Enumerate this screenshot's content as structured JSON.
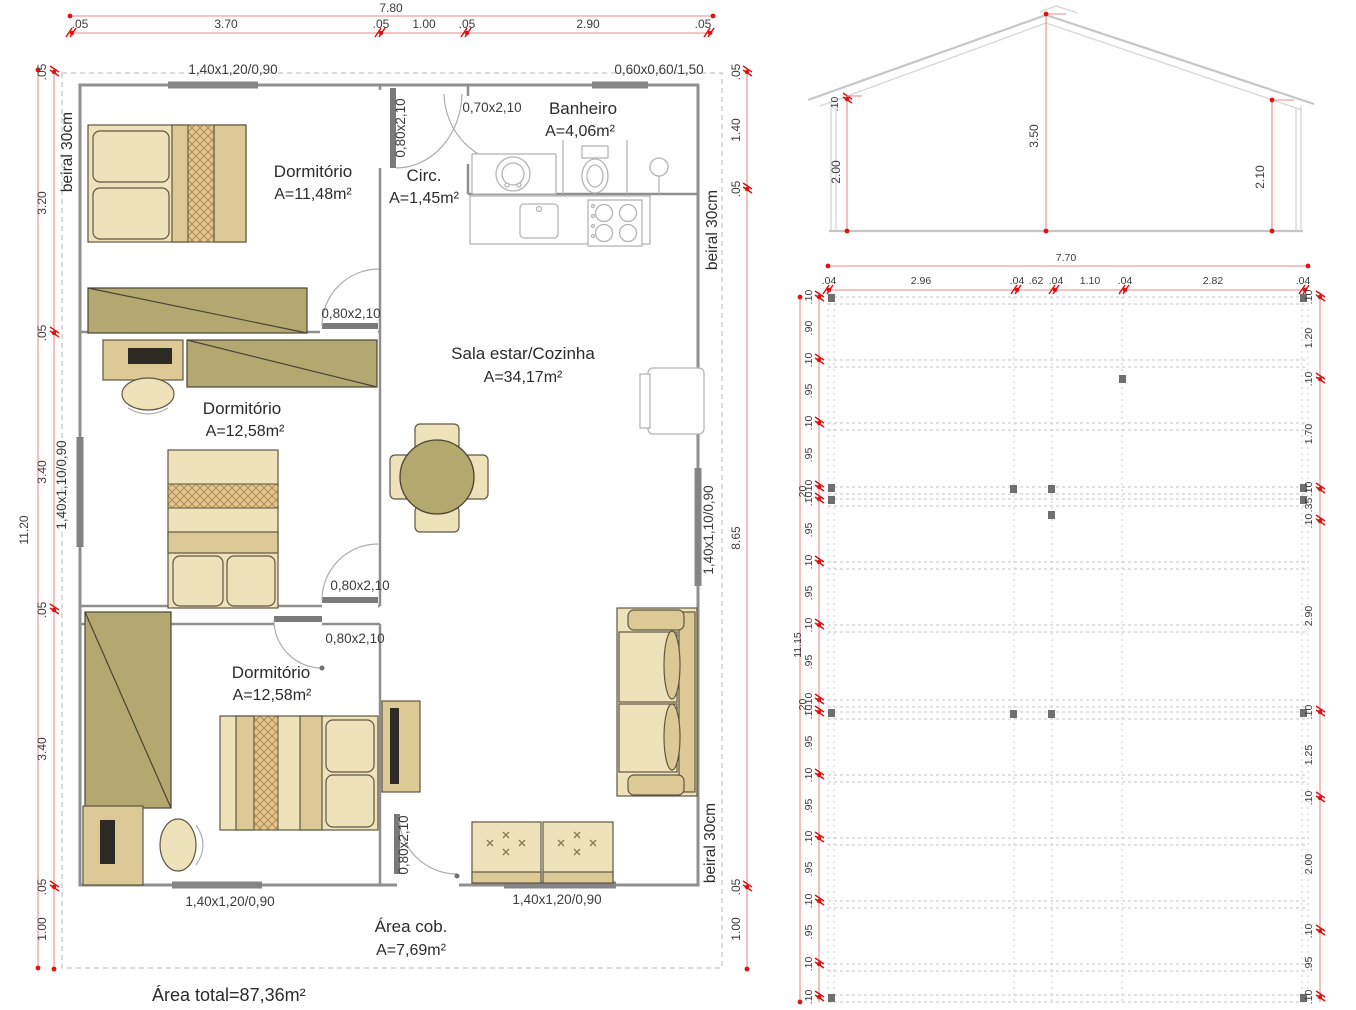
{
  "floor_plan": {
    "rooms": [
      {
        "name": "Dormitório",
        "area": "A=11,48m²"
      },
      {
        "name": "Circ.",
        "area": "A=1,45m²"
      },
      {
        "name": "Banheiro",
        "area": "A=4,06m²"
      },
      {
        "name": "Sala estar/Cozinha",
        "area": "A=34,17m²"
      },
      {
        "name": "Dormitório",
        "area": "A=12,58m²"
      },
      {
        "name": "Dormitório",
        "area": "A=12,58m²"
      },
      {
        "name": "Área cob.",
        "area": "A=7,69m²"
      }
    ],
    "total_area_label": "Área total=87,36m²",
    "eave_label": "beiral 30cm",
    "windows": {
      "top_left": "1,40x1,20/0,90",
      "top_right": "0,60x0,60/1,50",
      "left": "1,40x1,10/0,90",
      "right": "1,40x1,10/0,90",
      "bottom_left": "1,40x1,20/0,90",
      "bottom_right": "1,40x1,20/0,90"
    },
    "doors": {
      "circ_door": "0,80x2,10",
      "bath_door": "0,70x2,10",
      "dorm1_door": "0,80x2,10",
      "dorm2_door": "0,80x2,10",
      "dorm3_door": "0,80x2,10",
      "entry_door": "0,80x2,10"
    },
    "dims": {
      "top": {
        "overall": "7.80",
        "segments": [
          ".05",
          "3.70",
          ".05",
          "1.00",
          ".05",
          "2.90",
          ".05"
        ]
      },
      "left": {
        "overall": "11.20",
        "segments": [
          ".05",
          "3.20",
          ".05",
          "3.40",
          ".05",
          "3.40",
          ".05",
          "1.00"
        ]
      },
      "right": {
        "segments": [
          ".05",
          "1.40",
          ".05",
          "8.65",
          ".05",
          "1.00"
        ]
      }
    }
  },
  "elevation": {
    "dims": {
      "ridge": "3.50",
      "wall_left": "2.00",
      "wall_right": "2.10",
      "eave_offset": ".10"
    }
  },
  "foundation": {
    "dims": {
      "top": {
        "overall": "7.70",
        "segments": [
          ".04",
          "2.96",
          ".04",
          ".62",
          ".04",
          "1.10",
          ".04",
          "2.82",
          ".04"
        ]
      },
      "left": {
        "overall": "11.15",
        "bracket": ".20",
        "labels": [
          ".10",
          ".90",
          ".10",
          ".95",
          ".10",
          ".95",
          ".10",
          ".10",
          ".95",
          ".10",
          ".95",
          ".10",
          ".95",
          ".10",
          ".10",
          ".95",
          ".10",
          ".95",
          ".10",
          ".95",
          ".10",
          ".95",
          ".10",
          ".10"
        ]
      },
      "right": {
        "labels": [
          ".10",
          "1.20",
          ".10",
          "1.70",
          ".10",
          ".35",
          ".10",
          "2.90",
          ".10",
          "1.25",
          ".10",
          "2.00",
          ".10",
          ".95",
          ".10"
        ]
      }
    }
  },
  "colors": {
    "dimension_line": "#ee8a8a",
    "dimension_mark": "#e01111",
    "wall": "#8f8f8f",
    "furniture_tan": "#dcc996",
    "furniture_cream": "#eee2ba",
    "wardrobe_khaki": "#b4a871"
  }
}
